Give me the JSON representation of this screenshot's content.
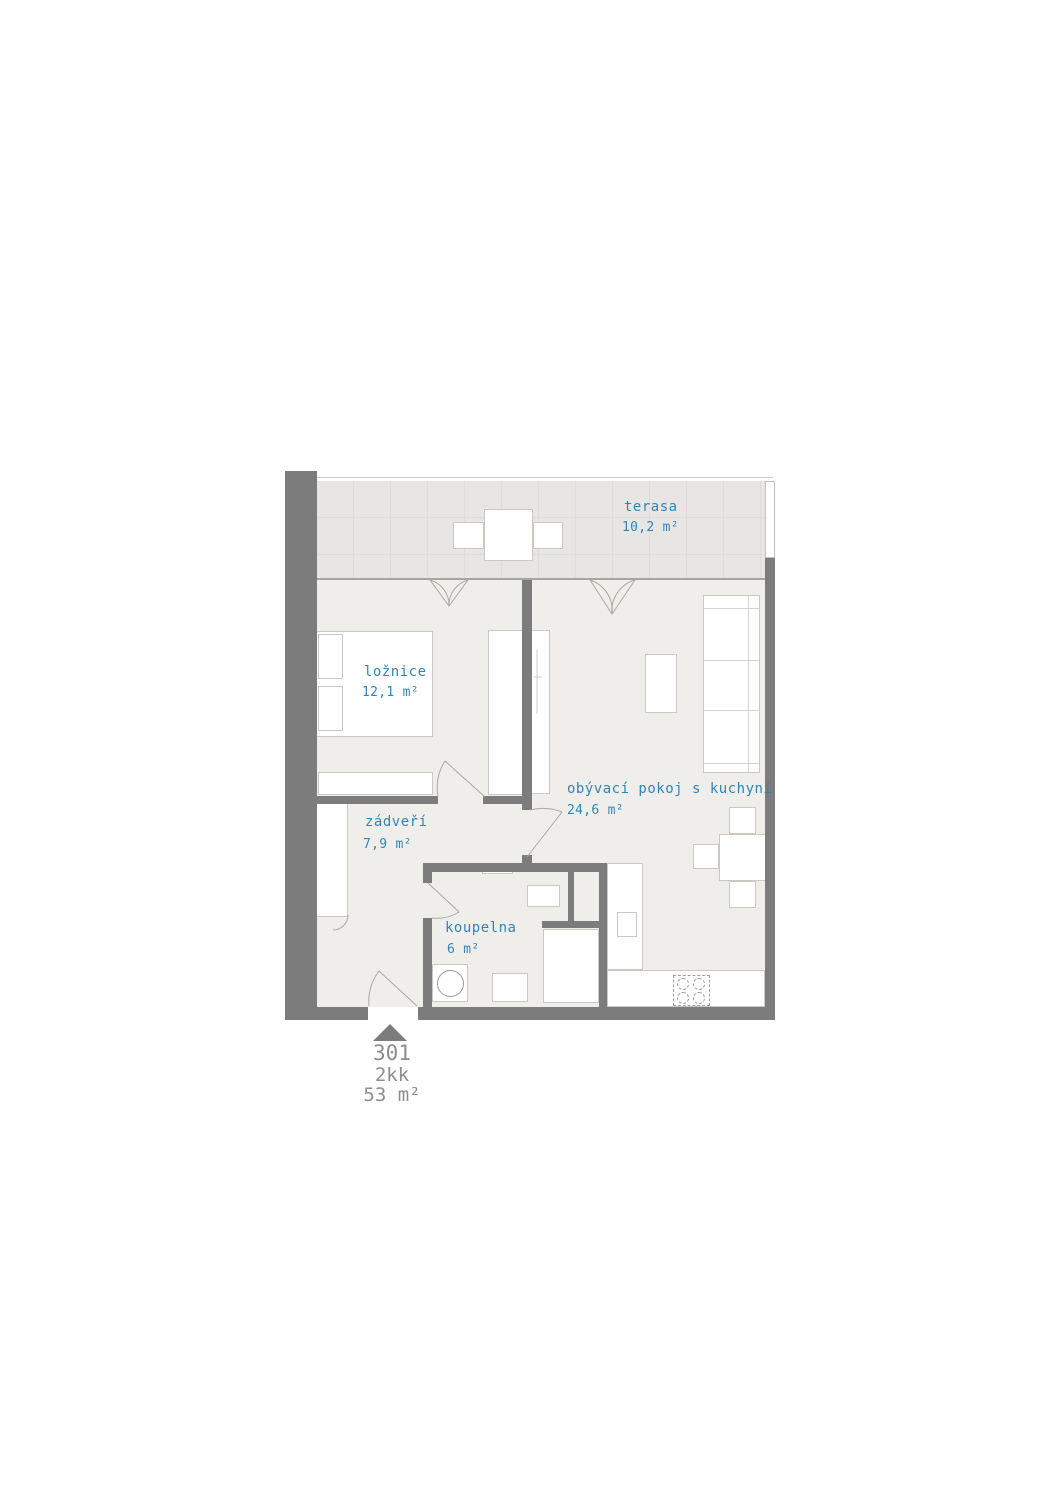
{
  "plan": {
    "title": "Floor plan",
    "unit": {
      "number": "301",
      "disposition": "2kk",
      "total_area": "53 m²"
    },
    "rooms": [
      {
        "name": "terasa",
        "area": "10,2 m²"
      },
      {
        "name": "ložnice",
        "area": "12,1 m²"
      },
      {
        "name": "obývací pokoj s kuchyní",
        "area": "24,6 m²"
      },
      {
        "name": "zádveří",
        "area": "7,9 m²"
      },
      {
        "name": "koupelna",
        "area": "6 m²"
      }
    ]
  },
  "colors": {
    "label_blue": "#2e86b8",
    "wall_gray": "#7c7c7c",
    "floor": "#f0eeea",
    "terrace": "#e7e6e4",
    "text_gray": "#8d8d8d"
  }
}
